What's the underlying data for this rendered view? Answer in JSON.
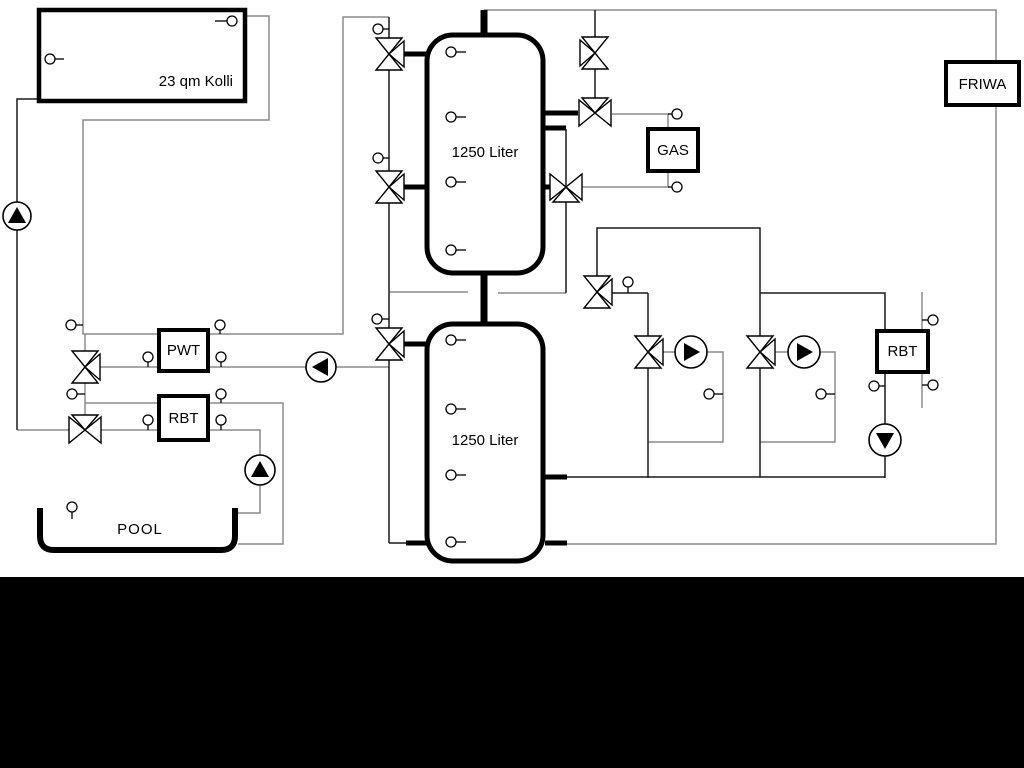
{
  "diagram": {
    "labels": {
      "collector": "23 qm Kolli",
      "tank_top": "1250 Liter",
      "tank_bottom": "1250 Liter",
      "pwt": "PWT",
      "rbt_left": "RBT",
      "rbt_right": "RBT",
      "gas": "GAS",
      "friwa": "FRIWA",
      "pool": "POOL"
    },
    "colors": {
      "pipe_gray": "#8c8c8c",
      "pipe_dark": "#1a1a1a",
      "component_outline": "#000000",
      "background": "#ffffff",
      "footer_bar": "#000000"
    },
    "components": {
      "storage_tanks": [
        "1250 Liter",
        "1250 Liter"
      ],
      "pump_count": 6,
      "three_way_valve_count": 11,
      "sensor_count": 30
    }
  }
}
